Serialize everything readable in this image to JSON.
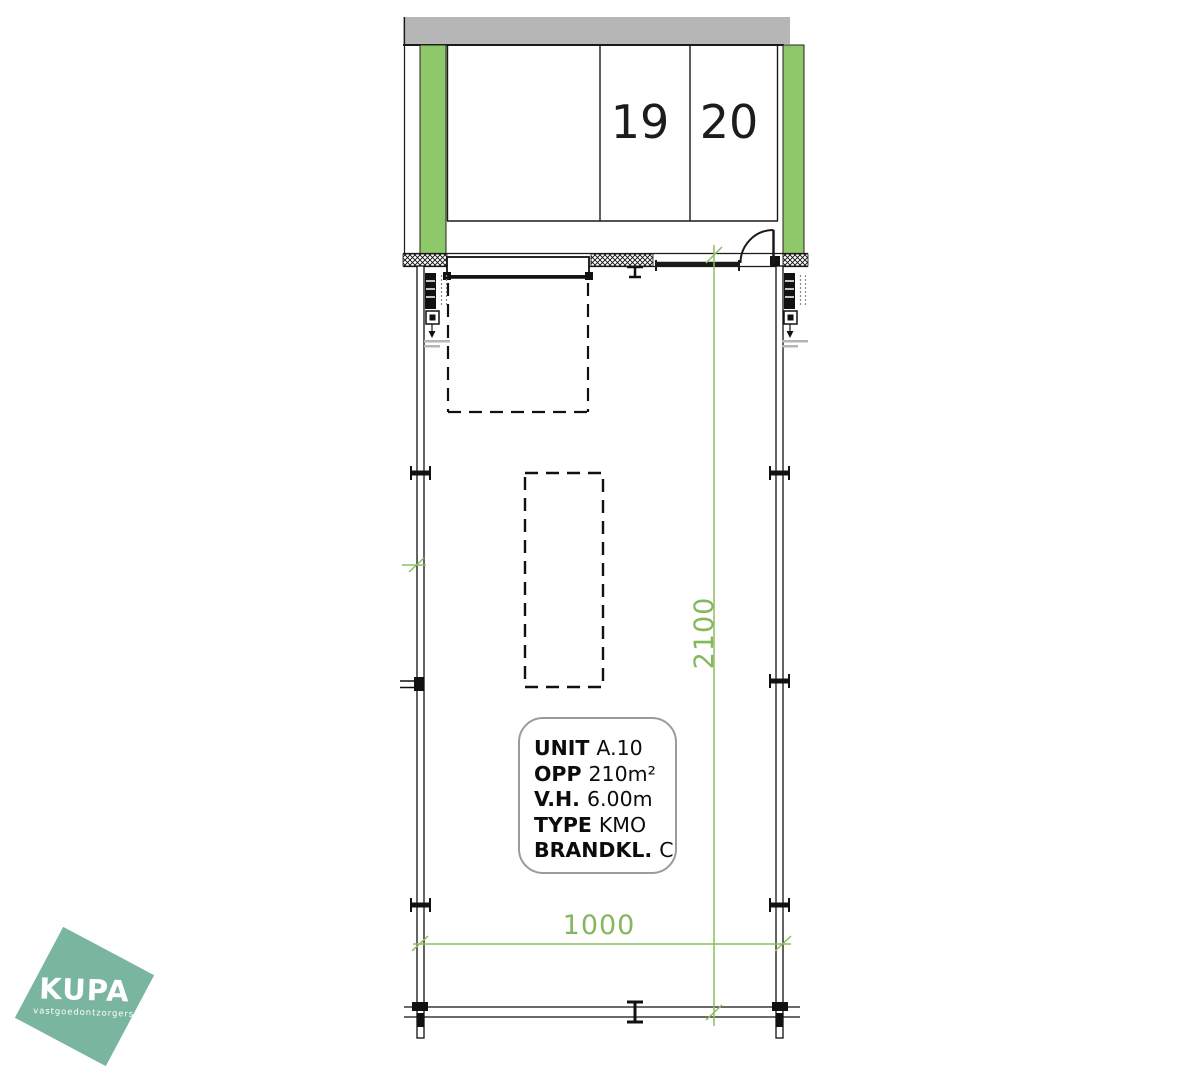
{
  "drawing": {
    "type": "architectural-floor-plan",
    "parking": {
      "spaces": [
        {
          "label": "19"
        },
        {
          "label": "20"
        }
      ]
    },
    "dimensions": {
      "vertical": "2100",
      "horizontal": "1000"
    },
    "unit_info": {
      "rows": [
        {
          "label": "UNIT",
          "value": "A.10"
        },
        {
          "label": "OPP",
          "value": "210m²"
        },
        {
          "label": "V.H.",
          "value": "6.00m"
        },
        {
          "label": "TYPE",
          "value": "KMO"
        },
        {
          "label": "BRANDKL.",
          "value": "C"
        }
      ]
    },
    "colors": {
      "structure_green": "#8fc868",
      "dimension_green": "#85b75b",
      "canopy_gray": "#b6b6b6",
      "line_black": "#1a1a1a",
      "logo_teal": "#7ab5a0"
    }
  },
  "logo": {
    "name": "KUPA",
    "tagline": "vastgoedontzorgers"
  }
}
